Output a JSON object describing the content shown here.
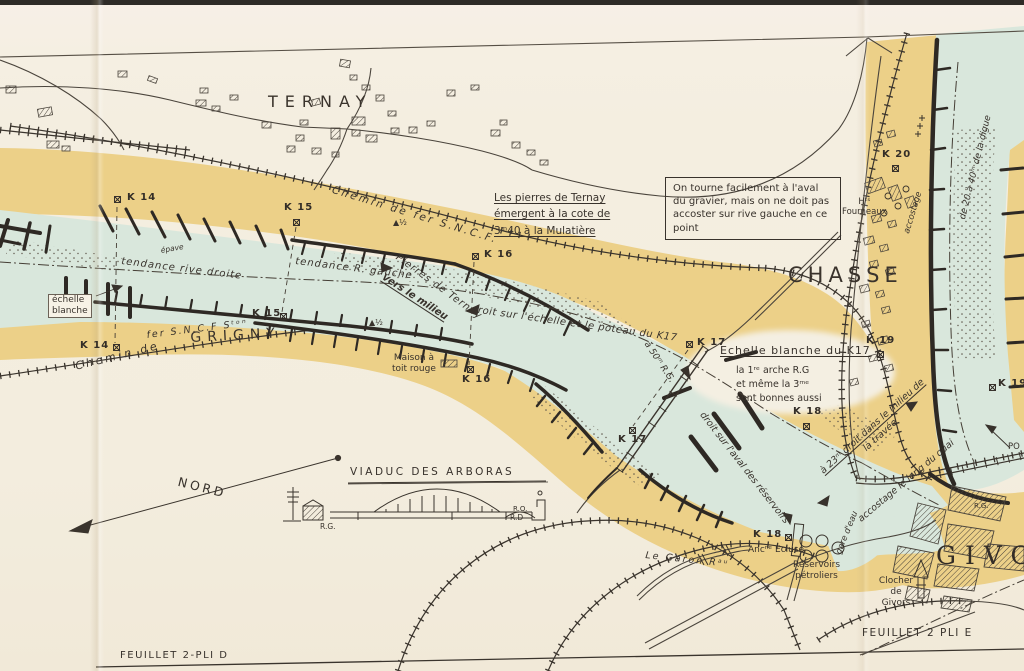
{
  "colors": {
    "paper": "#f4eee0",
    "sand": "#ecd088",
    "water": "#d9e7dc",
    "ink": "#38322c"
  },
  "towns": {
    "ternay": "TERNAY",
    "grigny": "GRIGNY",
    "chasse": "CHASSE",
    "givors": "GIVORS"
  },
  "railway": {
    "main": "Chemin de fer S.N.C.F.",
    "grigny_a": "Chemin de",
    "grigny_b": "fer S.N.C.F  Sᵗᵒⁿ"
  },
  "km_markers": {
    "k14_top": "K 14",
    "k15_top": "K 15",
    "k16_top": "K 16",
    "k14_low": "K 14",
    "k15_low": "K 15",
    "k16_low": "K 16",
    "k17_top": "K 17",
    "k17_low": "K 17",
    "k18_top": "K 18",
    "k18_low": "K 18",
    "k19_top": "K 19",
    "k19_right": "K 19",
    "k20": "K 20"
  },
  "notes": {
    "pierres_l1": "Les pierres de Ternay",
    "pierres_l2": "émergent à la cote de",
    "pierres_l3": "3ᵐ40 à la Mulatière",
    "warning": "On tourne facilement à l'aval du gravier, mais on ne doit pas accoster sur rive gauche en ce point",
    "tendance_droite": "tendance rive droite",
    "epave": "épave",
    "tendance_gauche": "tendance R. gauche",
    "pierres_ternay": "Pierres de Ternay",
    "vers_milieu": "vers le milieu",
    "droit_echelle": "droit sur l'échelle et le poteau du K17",
    "a_50m": "à 50ᵐ R.G.",
    "echelle_blanche_l1": "échelle",
    "echelle_blanche_l2": "blanche",
    "echelle_k17": "Echelle blanche du K17",
    "arche_l1": "la 1ʳᵉ arche R.G",
    "arche_l2": "et même la 3ᵐᵉ",
    "arche_l3": "sont bonnes aussi",
    "droit_aval": "droit sur l'aval des réservoirs",
    "a_23m_l1": "à 23ᵐ droit dans le milieu de",
    "a_23m_l2": "la travée",
    "accostage_quai": "accostage le long du quai",
    "gare_deau": "gare d'eau",
    "digue": "de 20 à 40ᵐ de la digue",
    "accostage_bank": "accostage",
    "half_mark": "▲½"
  },
  "places": {
    "maison_l1": "Maison à",
    "maison_l2": "toit rouge",
    "hts_l1": "Hᵗˢ",
    "hts_l2": "Fourneaux",
    "anc_ecluse": "Ancⁿᵉ Ecluse",
    "reservoirs_l1": "Réservoirs",
    "reservoirs_l2": "pétroliers",
    "le_garon": "Le Garon Rᵃᵘ",
    "clocher_l1": "Clocher",
    "clocher_l2": "de",
    "clocher_l3": "Givors",
    "viaduc": "VIADUC DES ARBORAS",
    "nord": "NORD",
    "rg": "R.G.",
    "rd": "R.D",
    "rg2": "R.G.",
    "ro": "R.O.",
    "po": "PO"
  },
  "sheets": {
    "pli_d": "FEUILLET 2-PLI D",
    "pli_e": "FEUILLET 2 PLI E"
  }
}
